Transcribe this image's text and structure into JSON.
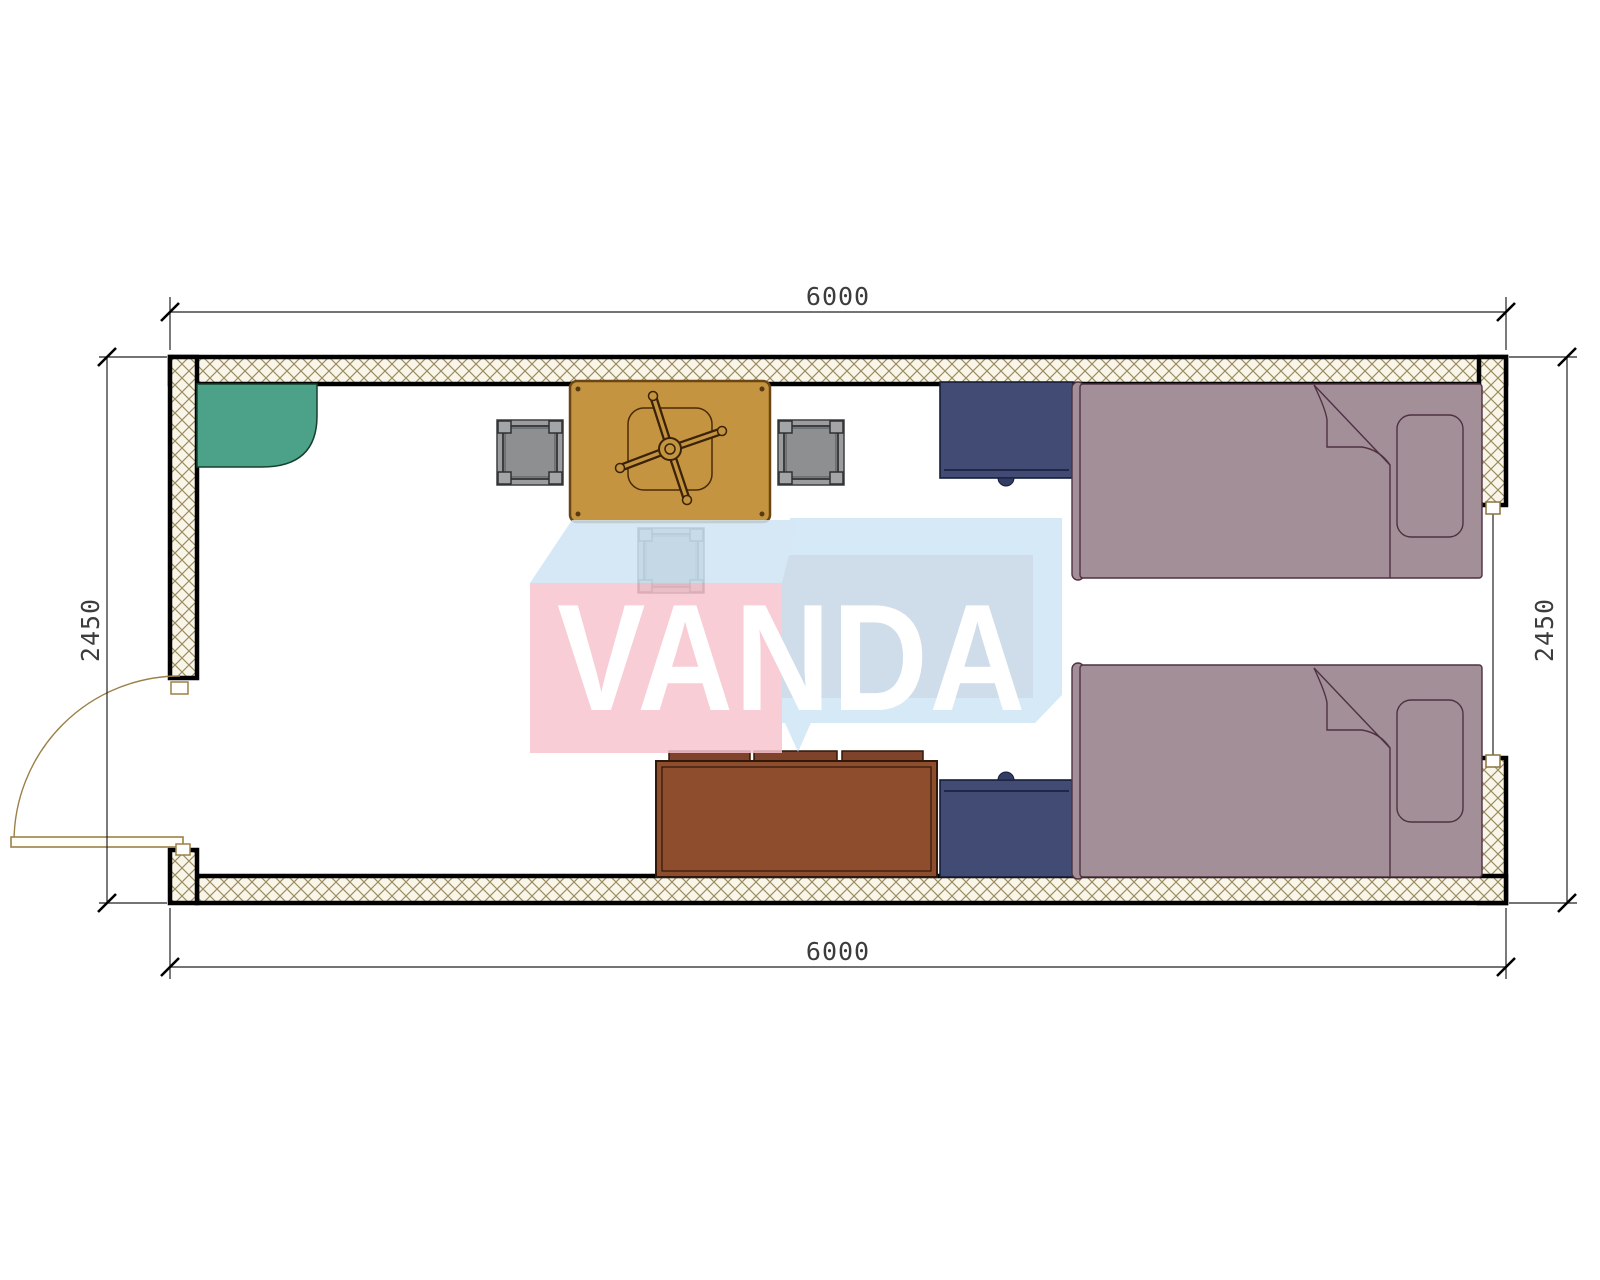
{
  "diagram": {
    "kind": "container cabin floor plan, top view",
    "watermark_text": "VANDA",
    "dims": {
      "top": "6000",
      "bottom": "6000",
      "left": "2450",
      "right": "2450"
    }
  },
  "colors": {
    "wall_hatch_bg": "#faf5e9",
    "wall_hatch_line": "#9b8d62",
    "wall_edge": "#000000",
    "door_frame": "#9b8147",
    "window_frame": "#8a7340",
    "corner_shelf": "#4ba288",
    "table": "#c49440",
    "chair_dark": "#3a2206",
    "stool": "#9b9c9e",
    "stool_inner": "#8d8f91",
    "nightstand": "#414b74",
    "nightstand_knob": "#333d63",
    "sofa": "#8e4d2d",
    "bed": "#a28f98",
    "bed_outline": "#4f3142",
    "dim_line": "#222222",
    "dim_text": "#3c3c3c",
    "logo_pink": "#f7c5cf",
    "logo_blue_top_left": "#cfe5f4",
    "logo_blue_top_right": "#d0e6f5",
    "logo_front_right": "#c7d6e6",
    "logo_text": "#ffffff"
  }
}
